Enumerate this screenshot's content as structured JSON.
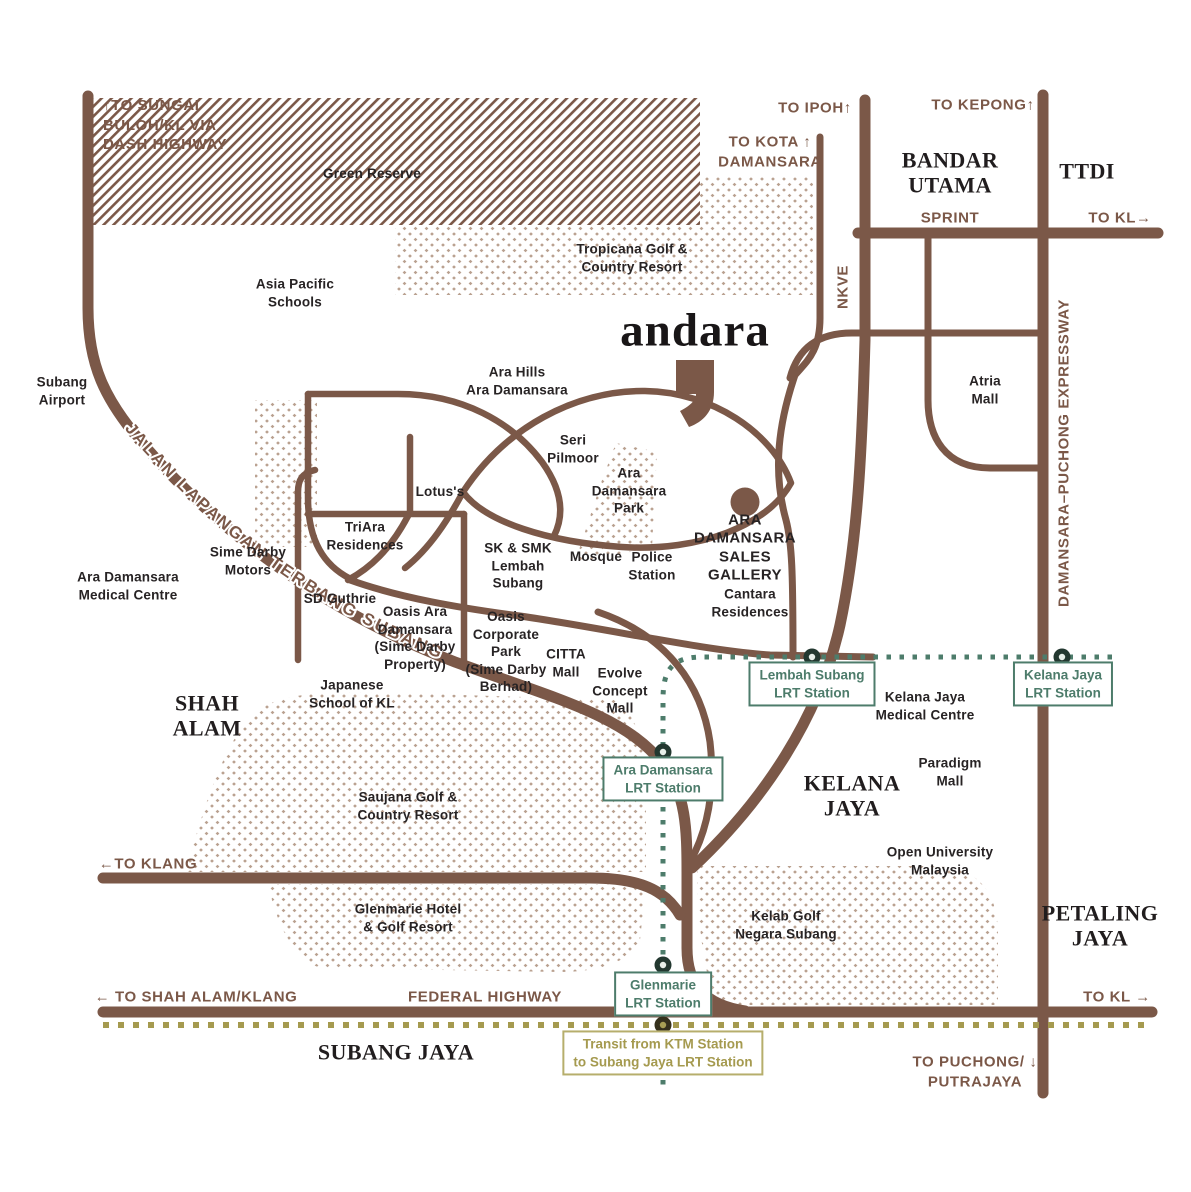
{
  "map": {
    "brand": "andara",
    "labels": {
      "to_sungai": "↑TO SUNGAI\nBULOH/KL VIA\nDASH HIGHWAY",
      "green_reserve": "Green Reserve",
      "tropicana": "Tropicana Golf &\nCountry Resort",
      "asia_pacific": "Asia Pacific\nSchools",
      "to_ipoh": "TO IPOH↑",
      "to_kota": "TO KOTA ↑\nDAMANSARA",
      "to_kepong": "TO KEPONG↑",
      "bandar_utama": "BANDAR\nUTAMA",
      "ttdi": "TTDI",
      "sprint": "SPRINT",
      "to_kl_top": "TO KL→",
      "nkve": "NKVE",
      "ldp": "DAMANSARA–PUCHONG EXPRESSWAY",
      "atria": "Atria\nMall",
      "subang_airport": "Subang\nAirport",
      "jalan": "JALAN LAPANGAN TERBANG SUBANG",
      "ara_hills": "Ara Hills\nAra Damansara",
      "seri_pilmoor": "Seri\nPilmoor",
      "ara_park": "Ara\nDamansara\nPark",
      "lotus": "Lotus's",
      "triara": "TriAra\nResidences",
      "sime_darby_motors": "Sime Darby\nMotors",
      "ara_medical": "Ara Damansara\nMedical Centre",
      "sd_guthrie": "SD Guthrie",
      "sk_smk": "SK & SMK\nLembah\nSubang",
      "mosque": "Mosque",
      "police": "Police\nStation",
      "sales_gallery": "ARA\nDAMANSARA\nSALES\nGALLERY",
      "cantara": "Cantara\nResidences",
      "oasis_ara": "Oasis Ara\nDamansara\n(Sime Darby\nProperty)",
      "oasis_corp": "Oasis\nCorporate\nPark\n(Sime Darby\nBerhad)",
      "citta": "CITTA\nMall",
      "evolve": "Evolve\nConcept\nMall",
      "japanese": "Japanese\nSchool of KL",
      "shah_alam": "SHAH\nALAM",
      "kj_medical": "Kelana Jaya\nMedical Centre",
      "paradigm": "Paradigm\nMall",
      "kelana_jaya": "KELANA\nJAYA",
      "open_univ": "Open University\nMalaysia",
      "saujana": "Saujana Golf &\nCountry Resort",
      "to_klang": "←TO KLANG",
      "glenmarie_hotel": "Glenmarie Hotel\n& Golf Resort",
      "kelab_golf": "Kelab Golf\nNegara Subang",
      "petaling": "PETALING\nJAYA",
      "to_shah_alam": "← TO SHAH ALAM/KLANG",
      "federal": "FEDERAL HIGHWAY",
      "to_kl_bottom": "TO KL →",
      "subang_jaya": "SUBANG JAYA",
      "to_puchong": "TO PUCHONG/ ↓\nPUTRAJAYA"
    },
    "stations": {
      "lembah": "Lembah Subang\nLRT Station",
      "kelana": "Kelana Jaya\nLRT Station",
      "ara_damansara": "Ara Damansara\nLRT Station",
      "glenmarie": "Glenmarie\nLRT Station",
      "transit": "Transit from KTM Station\nto Subang Jaya LRT Station"
    },
    "colors": {
      "road_brown": "#7b5848",
      "text_dark": "#272324",
      "lrt_green": "#4d7c6b",
      "ktm_olive": "#a59a4f",
      "dot_tan": "#b9a08f"
    }
  }
}
